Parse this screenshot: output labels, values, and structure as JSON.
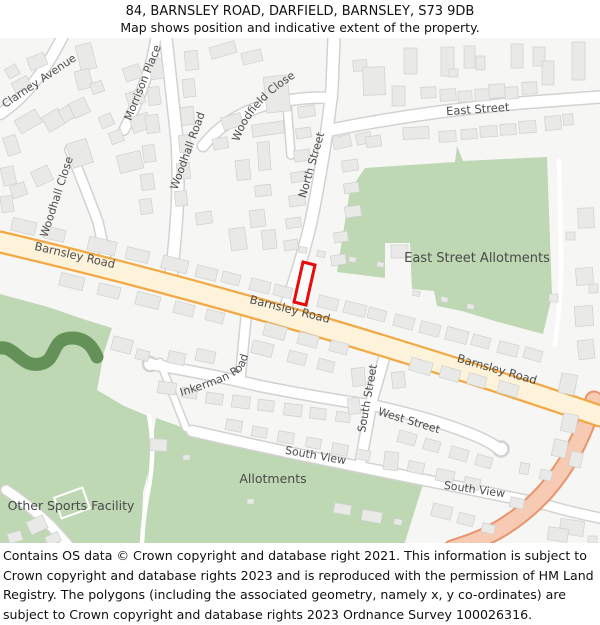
{
  "title": "84, BARNSLEY ROAD, DARFIELD, BARNSLEY, S73 9DB",
  "subtitle": "Map shows position and indicative extent of the property.",
  "footer": "Contains OS data © Crown copyright and database right 2021. This information is subject to Crown copyright and database rights 2023 and is reproduced with the permission of HM Land Registry. The polygons (including the associated geometry, namely x, y co-ordinates) are subject to Crown copyright and database rights 2023 Ordnance Survey 100026316.",
  "map": {
    "labels": {
      "clarney_avenue": "Clarney Avenue",
      "morrison_place": "Morrison Place",
      "woodhall_road": "Woodhall Road",
      "woodhall_close": "Woodhall Close",
      "woodfield_close": "Woodfield Close",
      "north_street": "North Street",
      "east_street": "East Street",
      "east_street_allotments": "East Street Allotments",
      "barnsley_road": "Barnsley Road",
      "inkerman_road": "Inkerman Road",
      "south_street": "South Street",
      "west_street": "West Street",
      "south_view": "South View",
      "allotments": "Allotments",
      "other_sports_facility": "Other Sports Facility"
    }
  },
  "colors": {
    "c-bg": "#f6f6f4",
    "c-green": "#bdd8b3",
    "c-green-dark": "#649158",
    "c-road-casing": "#d2d2d0",
    "c-aroad-fill": "#fdf3da",
    "c-aroad-casing": "#f2a843",
    "c-broad-fill": "#f7cab3",
    "c-broad-casing": "#e8956d",
    "c-bldg": "#e9e9e7",
    "c-bldg-stroke": "#d0d0ce",
    "c-red": "#e80c0c",
    "c-label": "#4d4d4d"
  }
}
